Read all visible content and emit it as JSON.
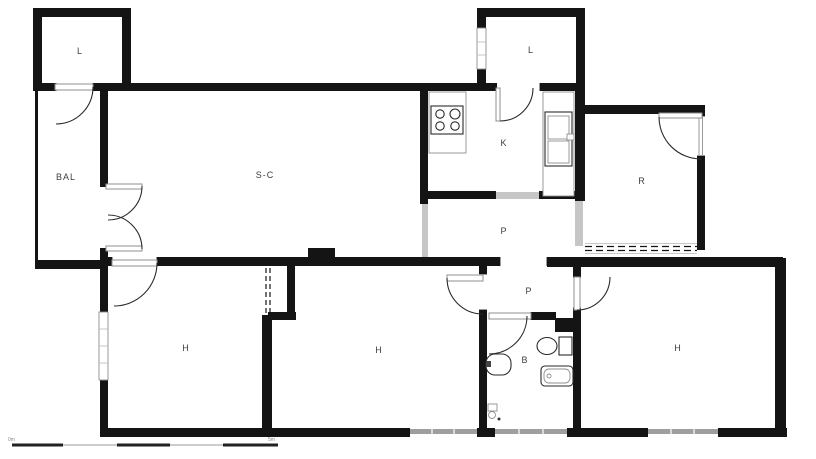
{
  "plan": {
    "rooms": [
      {
        "id": "laundry-top-left",
        "label": "L"
      },
      {
        "id": "laundry-top-center",
        "label": "L"
      },
      {
        "id": "balcony",
        "label": "BAL"
      },
      {
        "id": "living-dining",
        "label": "S-C"
      },
      {
        "id": "kitchen",
        "label": "K"
      },
      {
        "id": "room-r",
        "label": "R"
      },
      {
        "id": "hallway-upper",
        "label": "P"
      },
      {
        "id": "hallway-lower",
        "label": "P"
      },
      {
        "id": "bedroom-left",
        "label": "H"
      },
      {
        "id": "bedroom-middle",
        "label": "H"
      },
      {
        "id": "bathroom",
        "label": "B"
      },
      {
        "id": "bedroom-right",
        "label": "H"
      }
    ],
    "fixtures": [
      "stove-icon",
      "kitchen-sink-icon",
      "toilet-icon",
      "bidet-icon",
      "bathtub-icon"
    ],
    "scale_bar": {
      "start_label": "0m",
      "end_label": "5m"
    },
    "colors": {
      "wall": "#141414",
      "opening": "#c6c6c6",
      "window": "#9e9e9e",
      "background": "#ffffff",
      "label": "#3d3d3d",
      "line": "#2a2a2a",
      "line-light": "#8f8f8f"
    }
  }
}
